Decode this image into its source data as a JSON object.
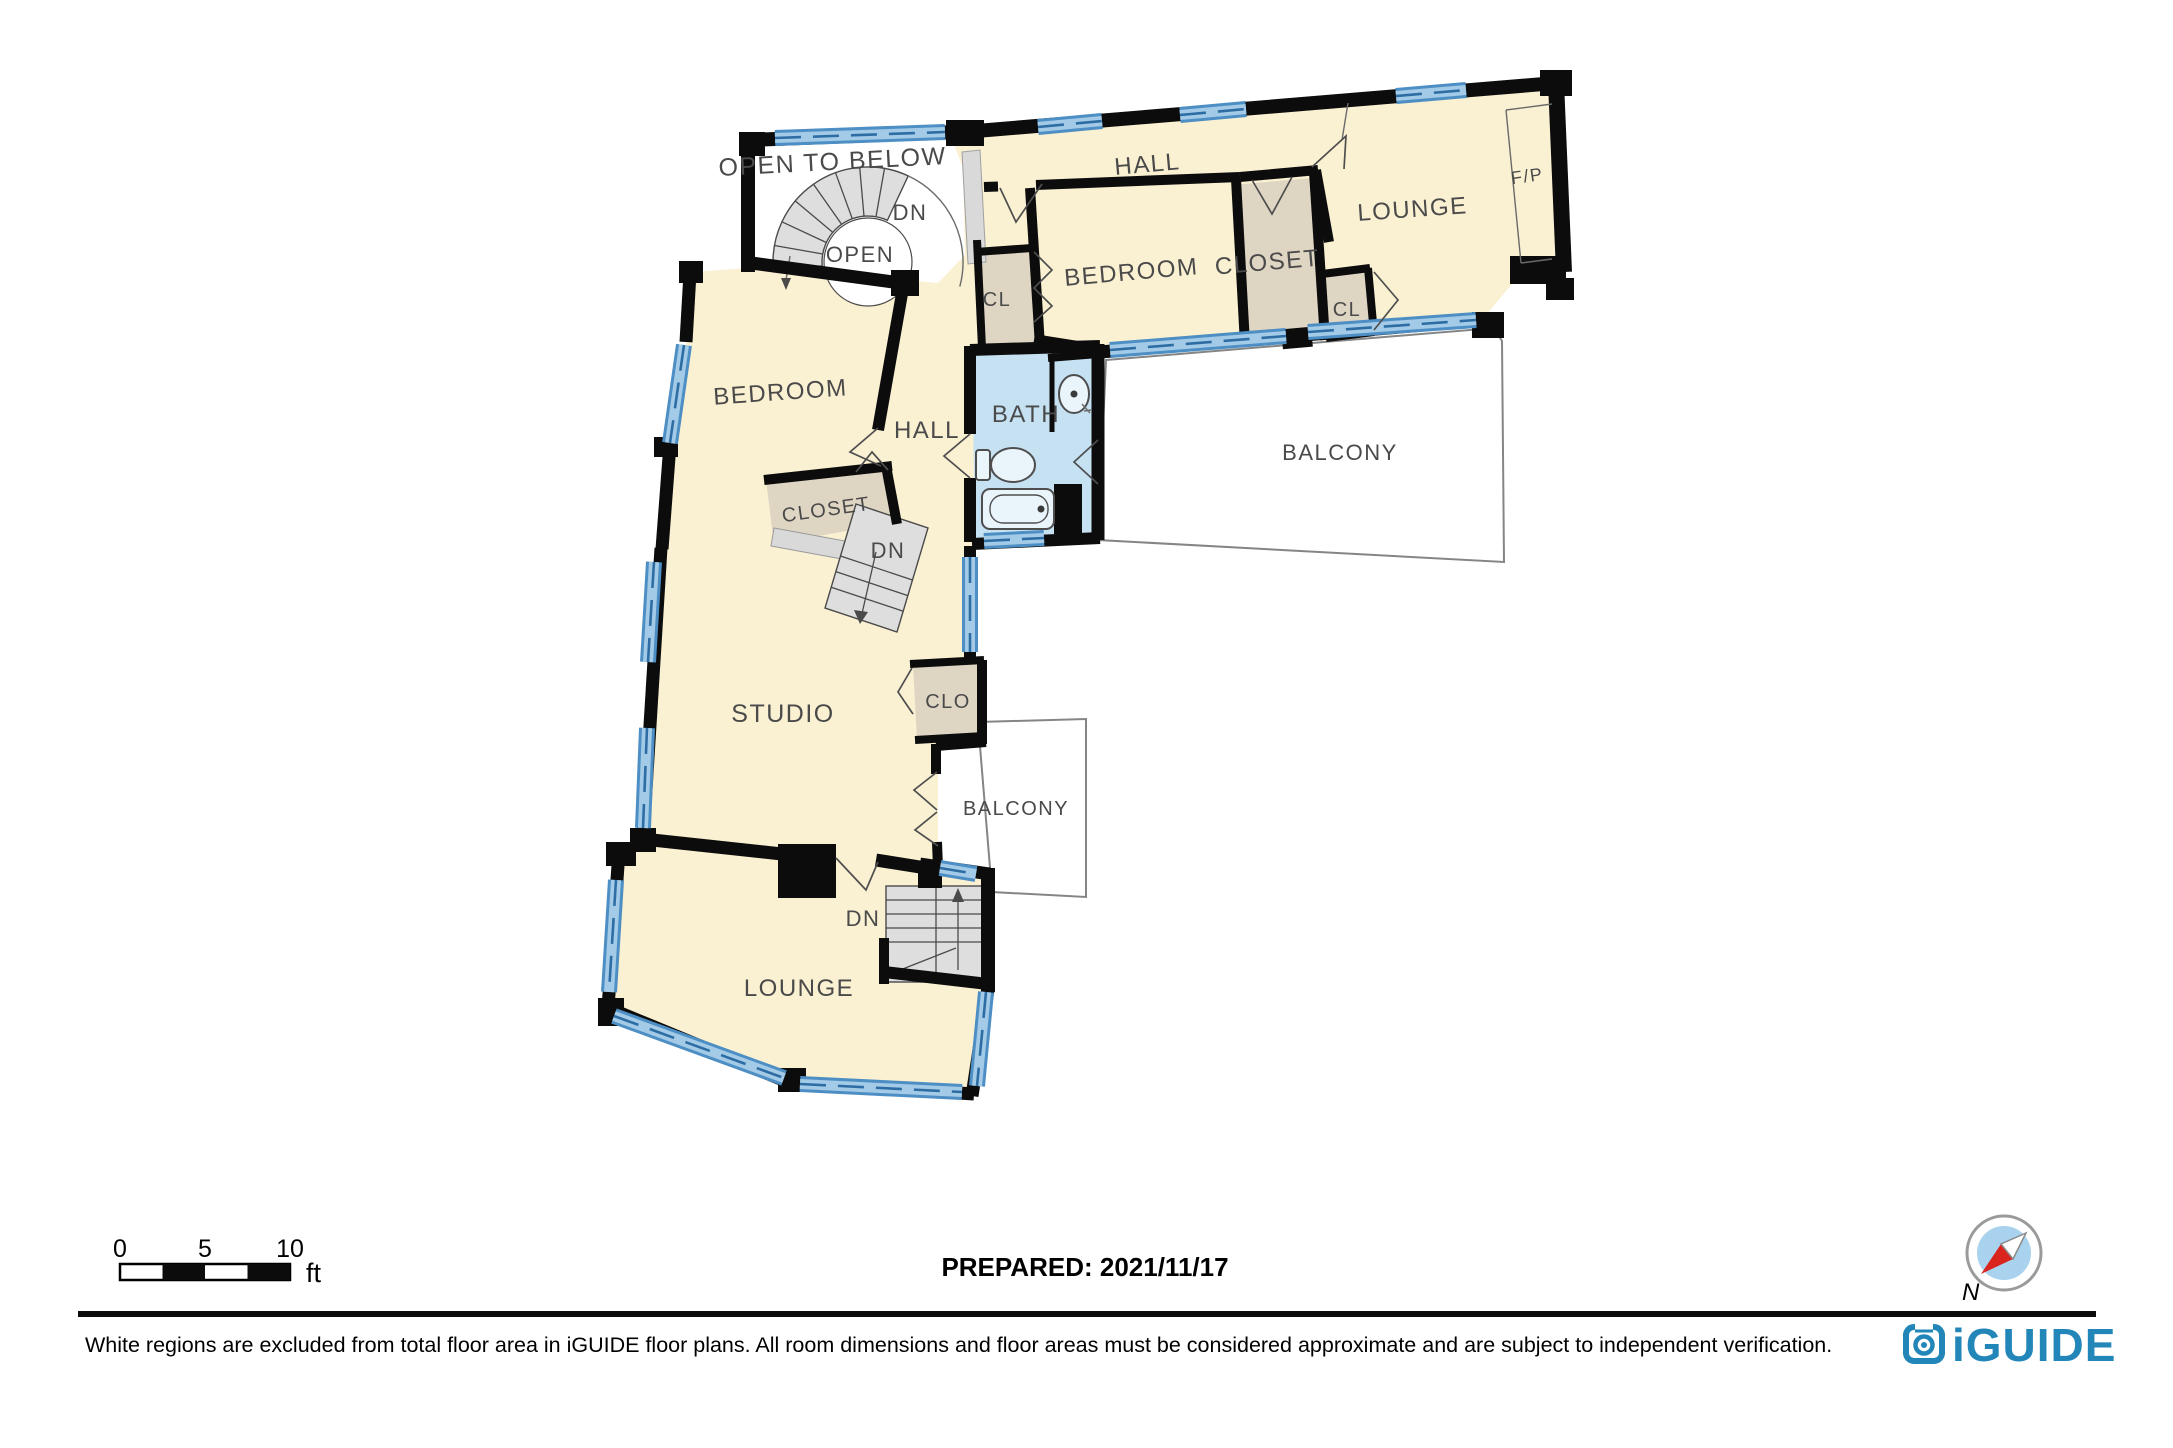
{
  "floorplan": {
    "labels": {
      "open_to_below": "OPEN TO BELOW",
      "dn_top": "DN",
      "open": "OPEN",
      "hall_top": "HALL",
      "bedroom_top": "BEDROOM",
      "closet_top": "CLOSET",
      "cl_left": "CL",
      "cl_right": "CL",
      "lounge_top": "LOUNGE",
      "fp": "F/P",
      "bedroom_left": "BEDROOM",
      "hall_mid": "HALL",
      "bath": "BATH",
      "closet_mid": "CLOSET",
      "dn_mid": "DN",
      "balcony_top": "BALCONY",
      "studio": "STUDIO",
      "clo": "CLO",
      "balcony_low": "BALCONY",
      "dn_low": "DN",
      "lounge_low": "LOUNGE"
    }
  },
  "scale_bar": {
    "ticks": [
      "0",
      "5",
      "10"
    ],
    "unit": "ft"
  },
  "prepared": {
    "text": "PREPARED: 2021/11/17"
  },
  "compass": {
    "north_label": "N"
  },
  "footer": {
    "disclaimer": "White regions are excluded from total floor area in iGUIDE floor plans. All room dimensions and floor areas must be considered approximate and are subject to independent verification.",
    "brand": "iGUIDE"
  },
  "colors": {
    "room_fill": "#faf0d2",
    "closet_fill": "#dfd5c3",
    "bath_fill": "#c5e1f2",
    "stair_fill": "#dedede",
    "gray_band": "#d9d9d9",
    "wall": "#0c0c0c",
    "window_blue": "#4d8fc4",
    "window_light": "#a3cbe7",
    "brand_blue": "#2386b8",
    "compass_red": "#d9251d",
    "compass_blue": "#a8d2ee"
  }
}
